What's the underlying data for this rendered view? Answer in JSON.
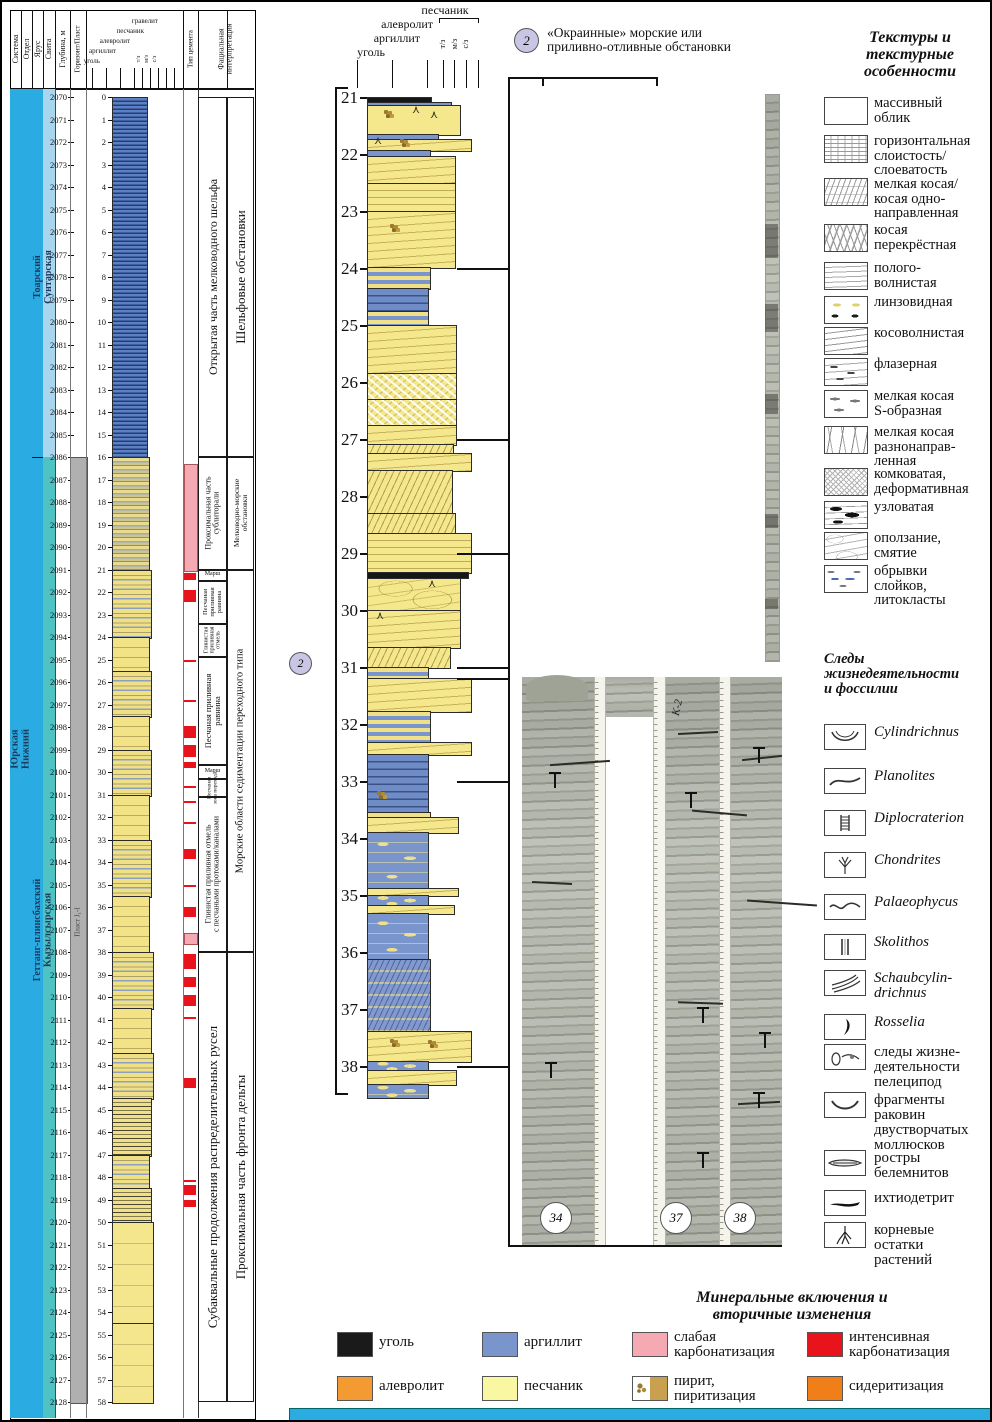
{
  "colors": {
    "cyan": "#2AACE2",
    "pale_blue": "#A9D6EF",
    "teal": "#4FC3C4",
    "gray": "#B0B0B0",
    "sand": "#F5E88C",
    "sand_pale": "#FAF7A3",
    "argillite": "#7A95CC",
    "coal": "#1A1A1A",
    "pink": "#F5A9B3",
    "red": "#E8131B",
    "siltstone_orange": "#F49A33",
    "siderite_orange": "#F07F1A",
    "pyrite_tan": "#C9A050",
    "badge_lavender": "#C9C6E5"
  },
  "left_panel": {
    "headers": {
      "system": "Система",
      "series": "Отдел",
      "stage": "Ярус",
      "formation": "Свита",
      "depth": "Глубина, м",
      "horizon": "Горизонт/Пласт",
      "cement": "Тип цемента",
      "facies": "Фациальная\nинтерпретация"
    },
    "lith_scale_labels": [
      "уголь",
      "аргиллит",
      "алевролит",
      "песчаник",
      "гравелит"
    ],
    "grain_labels": [
      "т/з",
      "м/з",
      "с/з"
    ],
    "stratigraphy": {
      "system": {
        "label": "Юрская",
        "from": 2070,
        "to": 2128
      },
      "series": {
        "label": "Нижний",
        "from": 2070,
        "to": 2128
      },
      "stages": [
        {
          "label": "Тоарский",
          "from": 2070,
          "to": 2086
        },
        {
          "label": "Геттанг-плинсбахский",
          "from": 2086,
          "to": 2128
        }
      ],
      "formations": [
        {
          "label": "Сунтарская",
          "from": 2070,
          "to": 2086,
          "color": "#A9D6EF"
        },
        {
          "label": "Кызылсырская",
          "from": 2086,
          "to": 2128,
          "color": "#4FC3C4"
        }
      ],
      "horizon": {
        "label": "Пласт J₁-I",
        "from": 2086,
        "to": 2128
      }
    },
    "depth_scale": {
      "from": 2070,
      "to": 2128
    },
    "core_scale": {
      "from": 0,
      "to": 58
    },
    "mini_segments": [
      [
        2070,
        2086,
        "m-arg",
        34
      ],
      [
        2086,
        2091,
        "m-het",
        36
      ],
      [
        2091,
        2094,
        "m-mx",
        38
      ],
      [
        2094,
        2095.5,
        "m-sx",
        36
      ],
      [
        2095.5,
        2097.5,
        "m-mx",
        38
      ],
      [
        2097.5,
        2099,
        "m-sx",
        36
      ],
      [
        2099,
        2101,
        "m-mx",
        38
      ],
      [
        2101,
        2103,
        "m-sx",
        36
      ],
      [
        2103,
        2105.5,
        "m-mx",
        38
      ],
      [
        2105.5,
        2108,
        "m-sx",
        36
      ],
      [
        2108,
        2110.5,
        "m-mx",
        40
      ],
      [
        2110.5,
        2112.5,
        "m-sx",
        38
      ],
      [
        2112.5,
        2114.5,
        "m-mx",
        40
      ],
      [
        2114.5,
        2117,
        "m-hx",
        38
      ],
      [
        2117,
        2118.5,
        "m-mx",
        36
      ],
      [
        2118.5,
        2120,
        "m-hx",
        38
      ],
      [
        2120,
        2124.5,
        "m-ms",
        40
      ],
      [
        2124.5,
        2128,
        "m-ms",
        40
      ]
    ],
    "cement_marks": {
      "pink": [
        [
          2086.3,
          2091.0
        ],
        [
          2107.15,
          2107.6
        ]
      ],
      "red": [
        [
          2091.15,
          2091.45
        ],
        [
          2091.9,
          2092.45
        ],
        [
          2097.95,
          2098.5
        ],
        [
          2098.8,
          2099.35
        ],
        [
          2099.55,
          2099.8
        ],
        [
          2103.4,
          2103.85
        ],
        [
          2106.0,
          2106.45
        ],
        [
          2108.1,
          2108.75
        ],
        [
          2109.1,
          2109.55
        ],
        [
          2109.9,
          2110.4
        ],
        [
          2113.6,
          2114.05
        ],
        [
          2118.35,
          2118.8
        ],
        [
          2119.0,
          2119.35
        ]
      ],
      "lines": [
        2095.0,
        2096.8,
        2100.6,
        2101.3,
        2102.2,
        2105.0,
        2110.9,
        2118.15
      ]
    },
    "facies_col1": [
      [
        2070,
        2086,
        "Открытая часть мелководного шельфа",
        12
      ],
      [
        2086,
        2091,
        "Проксимальная часть\nсублиторали",
        8
      ],
      [
        2091,
        2091.5,
        "Марш",
        6
      ],
      [
        2091.5,
        2093.4,
        "Песчаная\nприливная\nравнина",
        6.5
      ],
      [
        2093.4,
        2094.9,
        "Глинистая\nприливная\nотмель",
        6
      ],
      [
        2094.9,
        2099.7,
        "Песчаная приливная\nравнина",
        8.5
      ],
      [
        2099.7,
        2100.3,
        "Марш",
        6
      ],
      [
        2100.3,
        2101.1,
        "Песчаная\nзона перехода",
        5.5
      ],
      [
        2101.1,
        2108,
        "Глинистая приливная отмель\nс песчаными протоками/каналами",
        8
      ],
      [
        2108,
        2128,
        "Субаквальные продолжения распределительных русел",
        13
      ]
    ],
    "facies_col2": [
      [
        2070,
        2086,
        "Шельфовые обстановки",
        13
      ],
      [
        2086,
        2091,
        "Мелководно-морские\nобстановки",
        7.5
      ],
      [
        2091,
        2108,
        "Морские области седиментации переходного типа",
        10.5
      ],
      [
        2108,
        2128,
        "Проксимальная часть фронта дельты",
        13
      ]
    ],
    "zone_badge": "2"
  },
  "detail_panel": {
    "scale": {
      "from": 21,
      "to": 38
    },
    "header": {
      "sand": "песчаник",
      "silt": "алевролит",
      "clay": "аргиллит",
      "coal": "уголь",
      "grains": [
        "т/з",
        "м/з",
        "с/з"
      ]
    },
    "annotation": {
      "badge": "2",
      "text": "«Окраинные» морские или\nприливно-отливные обстановки"
    },
    "segments": [
      [
        21.0,
        21.08,
        63,
        "c-coal"
      ],
      [
        21.08,
        21.14,
        83,
        "c-arg"
      ],
      [
        21.14,
        21.65,
        92,
        "c-sand"
      ],
      [
        21.65,
        21.73,
        70,
        "c-arg"
      ],
      [
        21.73,
        21.93,
        103,
        "c-sand-wavy"
      ],
      [
        21.93,
        22.03,
        62,
        "c-arg"
      ],
      [
        22.03,
        22.5,
        87,
        "c-sand-wavy"
      ],
      [
        22.5,
        23.0,
        87,
        "c-sand-horiz"
      ],
      [
        23.0,
        23.98,
        87,
        "c-sand-wavy"
      ],
      [
        23.98,
        24.35,
        62,
        "c-mix"
      ],
      [
        24.35,
        24.75,
        60,
        "c-arg-dash"
      ],
      [
        24.75,
        25.0,
        60,
        "c-mix"
      ],
      [
        25.0,
        25.85,
        88,
        "c-sand-wavy"
      ],
      [
        25.85,
        26.3,
        88,
        "c-sand-lump"
      ],
      [
        26.3,
        26.75,
        88,
        "c-sand-lump"
      ],
      [
        26.75,
        27.08,
        88,
        "c-sand-wavy"
      ],
      [
        27.08,
        27.25,
        85,
        "c-sand-hatch"
      ],
      [
        27.25,
        27.55,
        103,
        "c-sand-wavy"
      ],
      [
        27.55,
        28.3,
        84,
        "c-sand-hatch"
      ],
      [
        28.3,
        28.65,
        87,
        "c-sand-hatch"
      ],
      [
        28.65,
        29.33,
        103,
        "c-sand-horiz"
      ],
      [
        29.33,
        29.43,
        100,
        "c-coal"
      ],
      [
        29.43,
        30.0,
        92,
        "c-sand-slump"
      ],
      [
        30.0,
        30.65,
        92,
        "c-sand-wavy"
      ],
      [
        30.65,
        31.0,
        82,
        "c-sand-hatch"
      ],
      [
        31.0,
        31.2,
        60,
        "c-mix"
      ],
      [
        31.2,
        31.78,
        103,
        "c-sand-wavy"
      ],
      [
        31.78,
        32.32,
        62,
        "c-mix"
      ],
      [
        32.32,
        32.52,
        103,
        "c-sand-wavy"
      ],
      [
        32.52,
        33.55,
        60,
        "c-arg-dash"
      ],
      [
        33.55,
        33.63,
        62,
        "c-mix"
      ],
      [
        33.63,
        33.9,
        90,
        "c-sand-wavy"
      ],
      [
        33.9,
        34.88,
        60,
        "c-arg-lens"
      ],
      [
        34.88,
        35.0,
        90,
        "c-sand-wavy"
      ],
      [
        35.0,
        35.18,
        60,
        "c-arg-lens"
      ],
      [
        35.18,
        35.32,
        86,
        "c-sand-wavy"
      ],
      [
        35.32,
        36.12,
        60,
        "c-arg-lens"
      ],
      [
        36.12,
        37.38,
        62,
        "c-arg-hatch"
      ],
      [
        37.38,
        37.92,
        103,
        "c-sand-wavy"
      ],
      [
        37.92,
        38.07,
        60,
        "c-arg-lens"
      ],
      [
        38.07,
        38.32,
        88,
        "c-sand-wavy"
      ],
      [
        38.32,
        38.55,
        60,
        "c-arg-lens"
      ]
    ],
    "markers": [
      {
        "m": 21.3,
        "x": 382,
        "t": "pyrite"
      },
      {
        "m": 21.22,
        "x": 410,
        "t": "root"
      },
      {
        "m": 21.32,
        "x": 428,
        "t": "root"
      },
      {
        "m": 21.8,
        "x": 398,
        "t": "pyrite"
      },
      {
        "m": 21.78,
        "x": 372,
        "t": "root"
      },
      {
        "m": 23.3,
        "x": 388,
        "t": "pyrite"
      },
      {
        "m": 29.55,
        "x": 426,
        "t": "root"
      },
      {
        "m": 30.1,
        "x": 374,
        "t": "root"
      },
      {
        "m": 33.25,
        "x": 375,
        "t": "pyrite"
      },
      {
        "m": 37.6,
        "x": 388,
        "t": "pyrite"
      },
      {
        "m": 37.62,
        "x": 426,
        "t": "pyrite"
      }
    ]
  },
  "core_photos": {
    "handwriting": "К-2",
    "numbers": [
      "34",
      "37",
      "38"
    ]
  },
  "legend_textures": {
    "title": "Текстуры и\nтекстурные\nособенности",
    "items": [
      {
        "icon": "massive",
        "label": "массивный\nоблик"
      },
      {
        "icon": "horizontal",
        "label": "горизонтальная\nслоистость/\nслоеватость"
      },
      {
        "icon": "xbed-uni",
        "label": "мелкая косая/\nкосая одно-\nнаправленная"
      },
      {
        "icon": "xbed-cross",
        "label": "косая\nперекрёстная"
      },
      {
        "icon": "gentle-wavy",
        "label": "полого-\nволнистая"
      },
      {
        "icon": "lenticular",
        "label": "линзовидная"
      },
      {
        "icon": "oblique-wavy",
        "label": "косоволнистая"
      },
      {
        "icon": "flaser",
        "label": "флазерная"
      },
      {
        "icon": "xbed-s",
        "label": "мелкая косая\nS-образная"
      },
      {
        "icon": "xbed-multi",
        "label": "мелкая косая\nразнонаправ-\nленная"
      },
      {
        "icon": "lumpy",
        "label": "комковатая,\nдеформативная"
      },
      {
        "icon": "nodular",
        "label": "узловатая"
      },
      {
        "icon": "slump",
        "label": "оползание,\nсмятие"
      },
      {
        "icon": "rip-up",
        "label": "обрывки\nслойков,\nлитокласты"
      }
    ]
  },
  "legend_fossils": {
    "title": "Следы\nжизнедеятельности\nи фоссилии",
    "items": [
      {
        "icon": "cylindrichnus",
        "label": "Cylindrichnus",
        "italic": true
      },
      {
        "icon": "planolites",
        "label": "Planolites",
        "italic": true
      },
      {
        "icon": "diplocraterion",
        "label": "Diplocraterion",
        "italic": true
      },
      {
        "icon": "chondrites",
        "label": "Chondrites",
        "italic": true
      },
      {
        "icon": "palaeophycus",
        "label": "Palaeophycus",
        "italic": true
      },
      {
        "icon": "skolithos",
        "label": "Skolithos",
        "italic": true
      },
      {
        "icon": "schaubcylindrichnus",
        "label": "Schaubcylin-\ndrichnus",
        "italic": true
      },
      {
        "icon": "rosselia",
        "label": "Rosselia",
        "italic": true
      },
      {
        "icon": "pelecypod-traces",
        "label": "следы жизне-\nдеятельности\nпелеципод",
        "italic": false
      },
      {
        "icon": "shell-fragments",
        "label": "фрагменты\nраковин\nдвустворчатых\nмоллюсков",
        "italic": false
      },
      {
        "icon": "belemnite",
        "label": "ростры\nбелемнитов",
        "italic": false
      },
      {
        "icon": "ichthyodetritus",
        "label": "ихтиодетрит",
        "italic": false
      },
      {
        "icon": "plant-roots",
        "label": "корневые\nостатки\nрастений",
        "italic": false
      }
    ]
  },
  "legend_minerals": {
    "title": "Минеральные включения и\nвторичные изменения",
    "items": [
      {
        "icon": "coal-swatch",
        "label": "уголь",
        "color": "#1A1A1A",
        "row": 0,
        "col": 0
      },
      {
        "icon": "argillite-swatch",
        "label": "аргиллит",
        "color": "#7A95CC",
        "row": 0,
        "col": 1
      },
      {
        "icon": "weak-carbonatization-swatch",
        "label": "слабая\nкарбонатизация",
        "color": "#F5A9B3",
        "row": 0,
        "col": 2
      },
      {
        "icon": "intense-carbonatization-swatch",
        "label": "интенсивная\nкарбонатизация",
        "color": "#E8131B",
        "row": 0,
        "col": 3
      },
      {
        "icon": "siltstone-swatch",
        "label": "алевролит",
        "color": "#F49A33",
        "row": 1,
        "col": 0
      },
      {
        "icon": "sandstone-swatch",
        "label": "песчаник",
        "color": "#FAF7A3",
        "row": 1,
        "col": 1
      },
      {
        "icon": "pyrite-swatch",
        "label": "пирит,\nпиритизация",
        "color": "#C9A050",
        "row": 1,
        "col": 2,
        "special": "pyrite"
      },
      {
        "icon": "sideritization-swatch",
        "label": "сидеритизация",
        "color": "#F07F1A",
        "row": 1,
        "col": 3
      }
    ]
  }
}
